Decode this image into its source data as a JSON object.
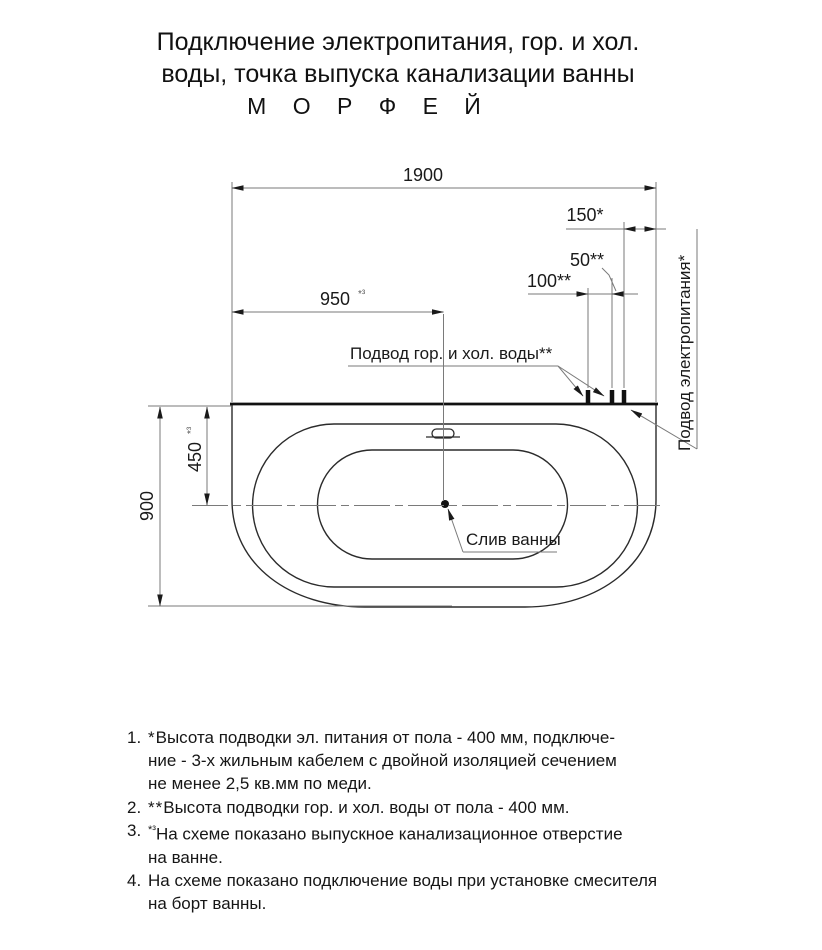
{
  "title": {
    "line1": "Подключение электропитания, гор. и хол.",
    "line2": "воды, точка выпуска канализации ванны",
    "line3": "М О Р Ф Е Й"
  },
  "dimensions": {
    "width_total": "1900",
    "drain_offset_x": "950",
    "drain_offset_x_note": "*³",
    "power_offset": "150*",
    "water_power_gap": "50**",
    "water_spacing": "100**",
    "depth_total": "900",
    "drain_offset_y": "450",
    "drain_offset_y_note": "*³"
  },
  "labels": {
    "water_supply": "Подвод гор. и хол. воды**",
    "power_supply": "Подвод электропитания*",
    "drain": "Слив ванны"
  },
  "notes": [
    {
      "num": "1.",
      "marker": "*",
      "text": "Высота подводки эл. питания от пола - 400 мм, подключе-\nние - 3-х жильным кабелем с двойной изоляцией сечением\nне менее 2,5 кв.мм по меди."
    },
    {
      "num": "2.",
      "marker": "**",
      "text": "Высота подводки гор. и хол. воды от пола - 400 мм."
    },
    {
      "num": "3.",
      "marker": "*³",
      "text": "На схеме показано выпускное канализационное отверстие\nна ванне."
    },
    {
      "num": "4.",
      "marker": "",
      "text": "На схеме показано подключение воды при установке смесителя\nна борт ванны."
    }
  ],
  "colors": {
    "ink": "#1a1a1a",
    "thin_line": "#7a7a7a",
    "contour": "#2b2b2b"
  }
}
